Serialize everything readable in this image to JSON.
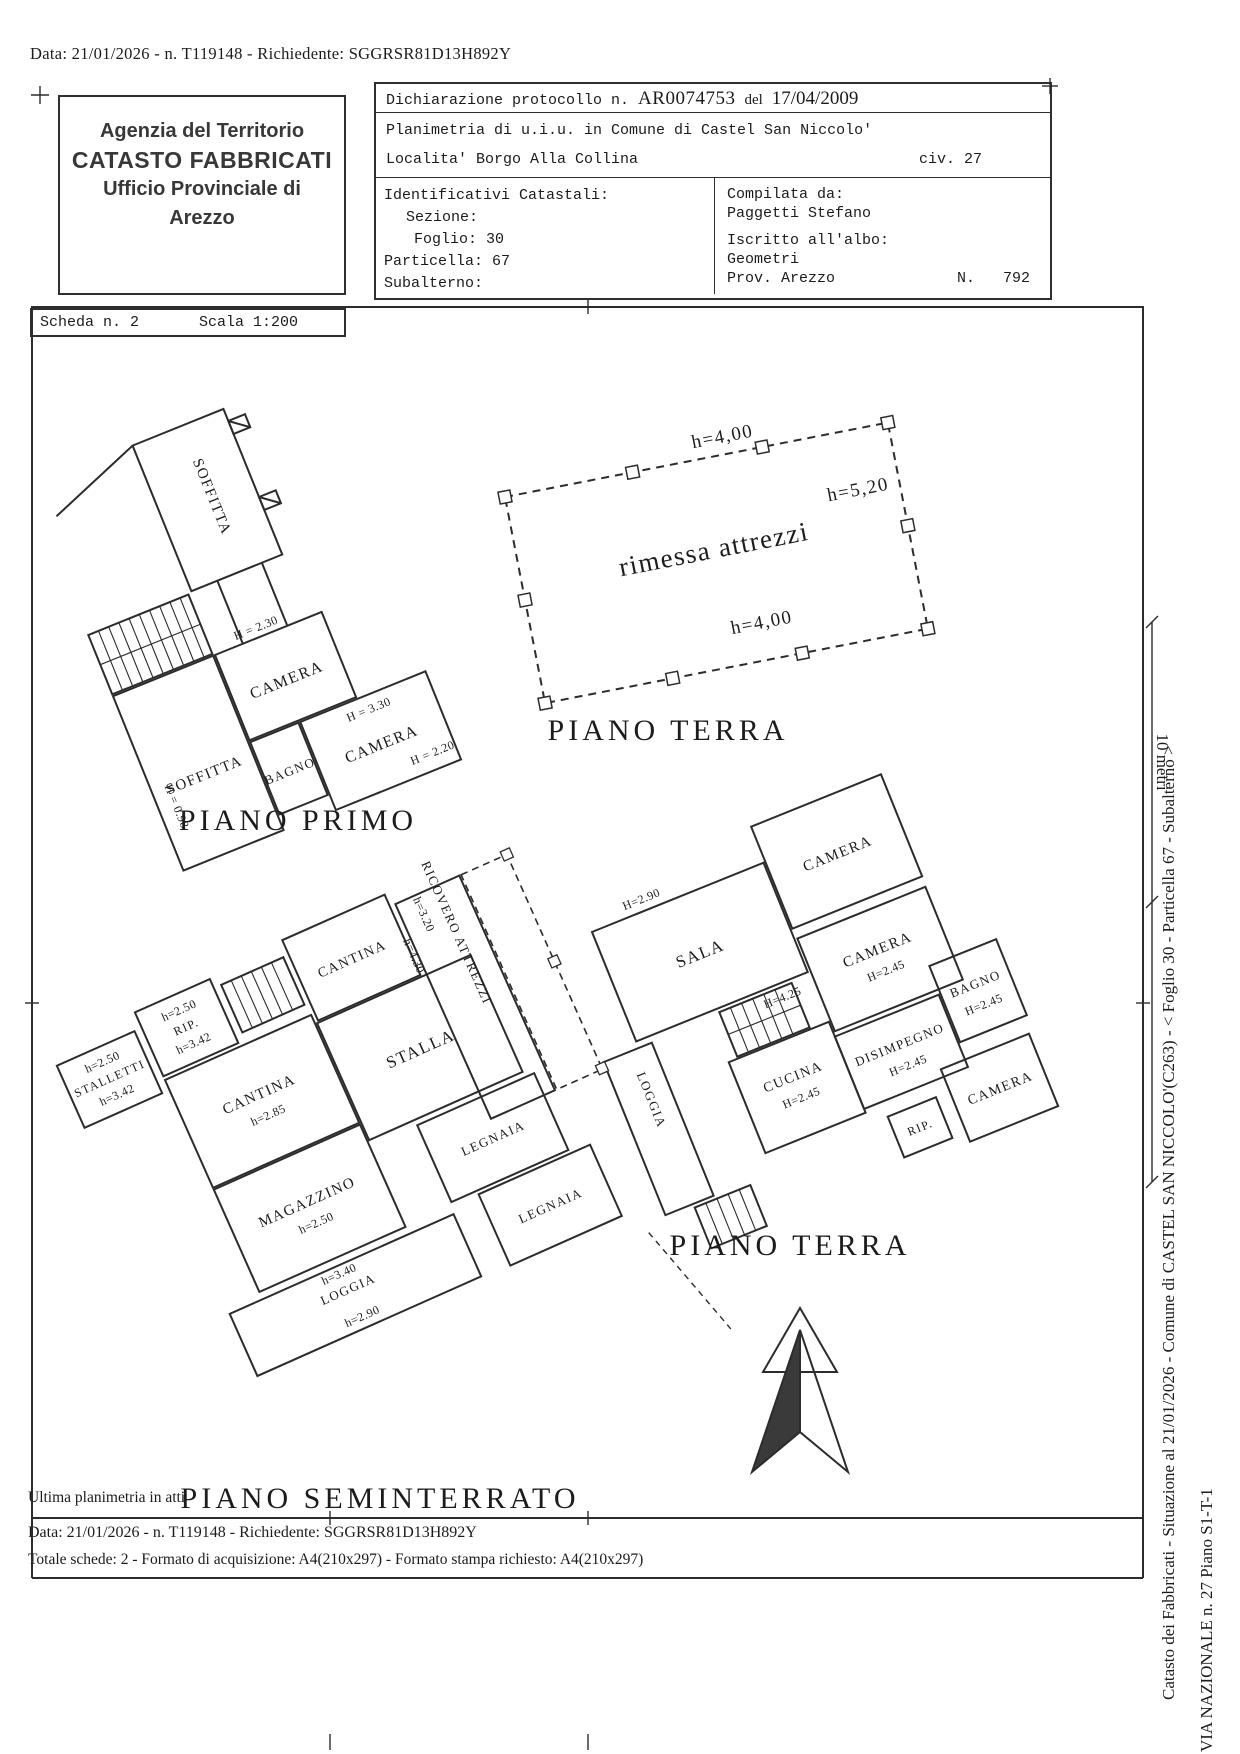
{
  "doc": {
    "top_line": "Data: 21/01/2026 - n. T119148 - Richiedente: SGGRSR81D13H892Y",
    "bottom_note": "Ultima planimetria in atti",
    "bottom_line1": "Data: 21/01/2026 - n. T119148 - Richiedente: SGGRSR81D13H892Y",
    "bottom_line2": "Totale schede: 2 - Formato di acquisizione: A4(210x297)  - Formato stampa richiesto: A4(210x297)",
    "side_text": "Catasto dei Fabbricati - Situazione al 21/01/2026 - Comune di CASTEL SAN NICCOLO'(C263) - <  Foglio 30 - Particella  67 - Subalterno   >",
    "side_address": "VIA NAZIONALE n. 27 Piano S1-T-1",
    "ruler_label": "10 metri"
  },
  "agency": {
    "line1": "Agenzia del Territorio",
    "line2": "CATASTO FABBRICATI",
    "line3": "Ufficio Provinciale di",
    "line4": "Arezzo"
  },
  "declaration": {
    "protocol_prefix": "Dichiarazione protocollo n.",
    "protocol_number": "AR0074753",
    "protocol_del": "del",
    "protocol_date": "17/04/2009",
    "line2": "Planimetria di u.i.u. in Comune di Castel San Niccolo'",
    "location": "Localita' Borgo Alla Collina",
    "civ": "civ. 27"
  },
  "catastali": {
    "title": "Identificativi Catastali:",
    "sezione": "Sezione:",
    "foglio": "Foglio: 30",
    "particella": "Particella: 67",
    "subalterno": "Subalterno:"
  },
  "compiler": {
    "label": "Compilata da:",
    "name": "Paggetti Stefano",
    "albo_label": "Iscritto all'albo:",
    "albo_value": "Geometri",
    "prov": "Prov. Arezzo",
    "n_label": "N.",
    "n_value": "792"
  },
  "scheda": {
    "number": "Scheda n. 2",
    "scale": "Scala 1:200"
  },
  "plans": {
    "piano_primo": {
      "title": "PIANO PRIMO",
      "soffitta_top": "SOFFITTA",
      "h_230": "H = 2.30",
      "camera1": "CAMERA",
      "h_330": "H = 3.30",
      "camera2": "CAMERA",
      "h_220": "H = 2.20",
      "bagno": "BAGNO",
      "soffitta_big": "SOFFITTA",
      "h_098": "H = 0.98"
    },
    "rimessa": {
      "title": "PIANO TERRA",
      "name": "rimessa attrezzi",
      "h_top": "h=4,00",
      "h_right": "h=5,20",
      "h_bottom": "h=4,00"
    },
    "piano_terra": {
      "title": "PIANO TERRA",
      "sala": "SALA",
      "h_sala": "H=2.90",
      "camera_top": "CAMERA",
      "h_425": "H=4.25",
      "camera_mid": "CAMERA",
      "h_camera_mid": "H=2.45",
      "cucina": "CUCINA",
      "h_cucina": "H=2.45",
      "disimpegno": "DISIMPEGNO",
      "h_disimpegno": "H=2.45",
      "bagno": "BAGNO",
      "h_bagno": "H=2.45",
      "loggia": "LOGGIA",
      "rip": "RIP.",
      "camera_bottom": "CAMERA"
    },
    "seminterrato": {
      "title": "PIANO SEMINTERRATO",
      "stalletti": "STALLETTI",
      "h_stalletti_top": "h=2.50",
      "h_stalletti_bot": "h=3.42",
      "rip": "RIP.",
      "h_rip_top": "h=2.50",
      "h_rip_bot": "h=3.42",
      "cantina_up": "CANTINA",
      "cantina_big": "CANTINA",
      "h_cantina": "h=2.85",
      "ricovero": "RICOVERO ATTREZZI",
      "h_ricovero": "h=3.20",
      "h_ricovero2": "h=4.30",
      "stalla": "STALLA",
      "magazzino": "MAGAZZINO",
      "h_magazzino": "h=2.50",
      "h_340": "h=3.40",
      "loggia": "LOGGIA",
      "h_loggia": "h=2.90",
      "legnaia1": "LEGNAIA",
      "legnaia2": "LEGNAIA"
    }
  }
}
